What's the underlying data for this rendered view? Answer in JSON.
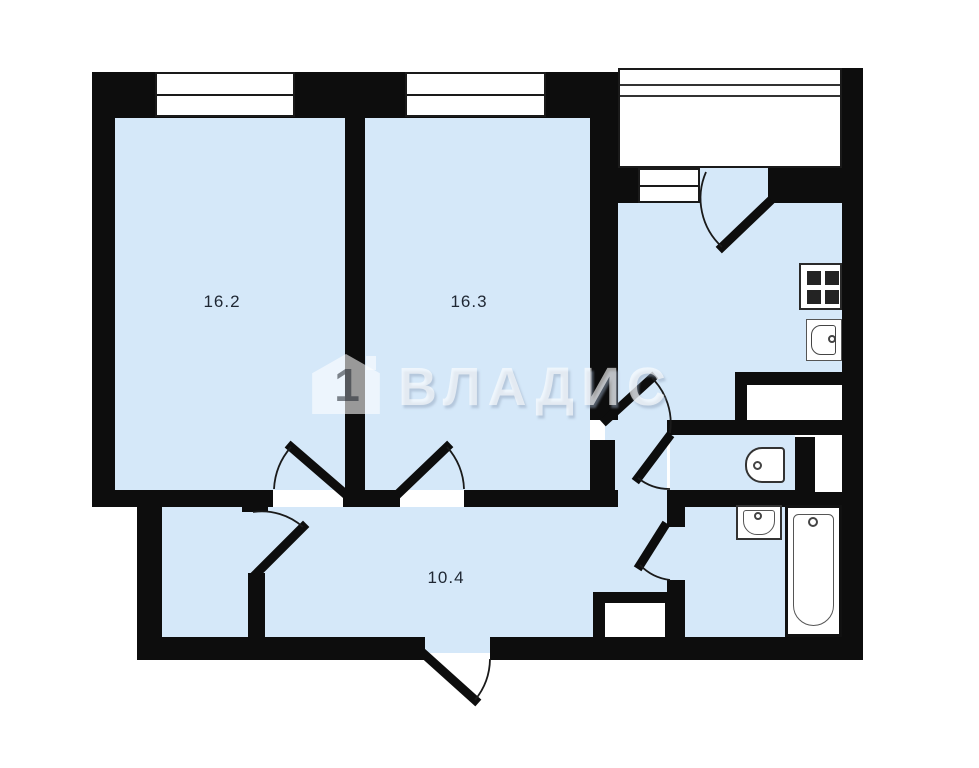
{
  "plan": {
    "title_note": "apartment floor plan",
    "rooms": [
      {
        "name": "room-1",
        "area": "16.2"
      },
      {
        "name": "room-2",
        "area": "16.3"
      },
      {
        "name": "hallway",
        "area": "10.4"
      }
    ],
    "watermark": {
      "brand": "ВЛАДИС",
      "logo_digit": "1"
    },
    "icons": [
      "stove-icon",
      "kitchen-sink-icon",
      "toilet-icon",
      "washbasin-icon",
      "bathtub-icon",
      "window-icon",
      "door-swing-icon",
      "balcony-glazing-icon"
    ],
    "colors": {
      "wall": "#0d0d0d",
      "floor": "#d5e8f9",
      "label": "#1f2733",
      "watermark": "#ffffff"
    }
  }
}
